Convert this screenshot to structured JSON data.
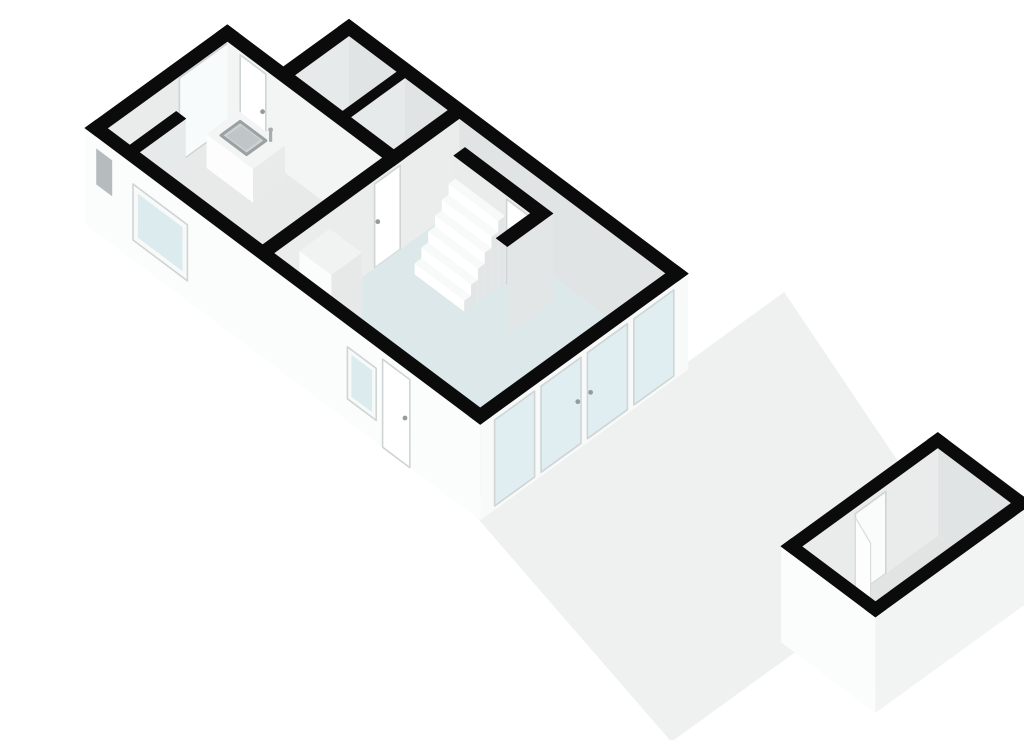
{
  "canvas": {
    "width": 1024,
    "height": 724,
    "background": "#ffffff"
  },
  "view": {
    "type": "3d-floorplan-render",
    "floor": "ground-floor-with-garden-shed"
  },
  "projection": {
    "ox": 45,
    "oy": 200,
    "a": [
      0.8,
      -0.58
    ],
    "b": [
      0.8,
      0.6
    ],
    "wallHeight": 88
  },
  "colors": {
    "bg": "#ffffff",
    "band": "#0b0b0c",
    "terrace": "#eff1f1",
    "kitchenFloor": "#e8eae9",
    "livingFloor": "#dce8ea",
    "annexFloor": "#d8dcdc",
    "nookFloor": "#c7cbcc",
    "shedFloor": "#e2e4e4",
    "faceOuterSW": "#fbfcfc",
    "faceOuterSE": "#f2f4f4",
    "faceInnerBright": "#f3f5f5",
    "faceInnerMid": "#e9eceb",
    "faceInnerDark": "#e0e4e4",
    "facePartition": "#eaedec",
    "faceDivider": "#e7eaea",
    "faceEnd": "#e3e6e6",
    "glassPane": "#dcebee",
    "glassBright": "#f7fbfb",
    "frameWhite": "#f8fafa",
    "frameEdge": "#cfd4d5",
    "doorWhite": "#ffffff",
    "handle": "#949b9e",
    "slitDark": "#b6bcbe",
    "islandTop": "#f3f4f4",
    "islandSW": "#fdfdfd",
    "islandSE": "#e9ebeb",
    "sinkBasin": "#cdd3d4",
    "sinkRim": "#9aa1a3",
    "sinkInner": "#c0c6c8",
    "faucet": "#a7adaf",
    "cabTop": "#f1f2f2",
    "cabSW": "#fbfcfc",
    "cabSE": "#e7e9e9",
    "treadTop": "#f8fafa",
    "treadSW": "#ffffff",
    "treadSE": "#e3e6e6",
    "burner": "#3f4446",
    "doorway": "#fafcfc",
    "leaf": "#fdfdfd",
    "leafEdge": "#d8dcdd"
  },
  "scene": [
    {
      "t": "poly",
      "name": "terrace-floor",
      "pts": [
        [
          -6,
          494
        ],
        [
          380,
          494
        ],
        [
          284,
          782
        ],
        [
          88,
          782
        ],
        [
          88,
          806
        ],
        [
          -73,
          806
        ]
      ],
      "fill": "terrace"
    },
    {
      "t": "face",
      "name": "nw-wall-inner-face",
      "plane": "b",
      "at": 14,
      "u": [
        14,
        178
      ],
      "h": [
        0,
        88
      ],
      "fill": "faceInnerMid"
    },
    {
      "t": "face",
      "name": "kitchen-window-inner",
      "plane": "b",
      "at": 14,
      "u": [
        104,
        170
      ],
      "h": [
        2,
        86
      ],
      "fill": "glassBright",
      "frame": "frameEdge"
    },
    {
      "t": "band",
      "name": "nw-wall-top",
      "a": [
        0,
        178
      ],
      "b": [
        0,
        14
      ]
    },
    {
      "t": "face",
      "name": "ne-wall-inner-face",
      "plane": "a",
      "at": 246,
      "u": [
        84,
        480
      ],
      "h": [
        0,
        88
      ],
      "fill": "faceInnerDark"
    },
    {
      "t": "band",
      "name": "ne-wall-top",
      "a": [
        246,
        260
      ],
      "b": [
        70,
        494
      ]
    },
    {
      "t": "face",
      "name": "annex-nw-wall-inner-face",
      "plane": "b",
      "at": 84,
      "u": [
        178,
        246
      ],
      "h": [
        0,
        88
      ],
      "fill": "faceDivider"
    },
    {
      "t": "band",
      "name": "annex-nw-wall-top",
      "a": [
        178,
        260
      ],
      "b": [
        70,
        84
      ]
    },
    {
      "t": "poly",
      "name": "closet-left-floor",
      "pts": [
        [
          178,
          84
        ],
        [
          246,
          84
        ],
        [
          246,
          144
        ],
        [
          178,
          144
        ]
      ],
      "fill": "annexFloor"
    },
    {
      "t": "poly",
      "name": "closet-right-floor",
      "pts": [
        [
          178,
          154
        ],
        [
          246,
          154
        ],
        [
          246,
          208
        ],
        [
          178,
          208
        ]
      ],
      "fill": "annexFloor"
    },
    {
      "t": "face",
      "name": "closet-divider-face",
      "plane": "b",
      "at": 154,
      "u": [
        178,
        246
      ],
      "h": [
        0,
        88
      ],
      "fill": "faceDivider"
    },
    {
      "t": "band",
      "name": "closet-divider-top",
      "a": [
        178,
        246
      ],
      "b": [
        144,
        154
      ]
    },
    {
      "t": "face",
      "name": "kitchen-ne-wall-face",
      "plane": "a",
      "at": 164,
      "u": [
        14,
        208
      ],
      "h": [
        0,
        88
      ],
      "fill": "faceInnerBright"
    },
    {
      "t": "face",
      "name": "kitchen-door",
      "plane": "a",
      "at": 164,
      "u": [
        30,
        62
      ],
      "h": [
        0,
        84
      ],
      "fill": "doorWhite",
      "frame": "frameEdge",
      "handle": [
        58,
        44
      ]
    },
    {
      "t": "band",
      "name": "kitchen-ne-wall-top",
      "a": [
        164,
        178
      ],
      "b": [
        0,
        222
      ]
    },
    {
      "t": "face",
      "name": "sw-wall-inner-kitchen",
      "plane": "a",
      "at": 14,
      "u": [
        14,
        208
      ],
      "h": [
        0,
        88
      ],
      "fill": "kitchenFloor"
    },
    {
      "t": "face",
      "name": "sw-wall-inner-living",
      "plane": "a",
      "at": 14,
      "u": [
        222,
        480
      ],
      "h": [
        0,
        88
      ],
      "fill": "livingFloor"
    },
    {
      "t": "face",
      "name": "partition-nw-fill",
      "plane": "b",
      "at": 208,
      "u": [
        14,
        164
      ],
      "h": [
        0,
        88
      ],
      "fill": "kitchenFloor"
    },
    {
      "t": "poly",
      "name": "kitchen-floor",
      "pts": [
        [
          14,
          14
        ],
        [
          164,
          14
        ],
        [
          164,
          208
        ],
        [
          14,
          208
        ]
      ],
      "fill": "kitchenFloor"
    },
    {
      "t": "poly",
      "name": "meter-nook-floor",
      "pts": [
        [
          14,
          14
        ],
        [
          72,
          14
        ],
        [
          72,
          42
        ],
        [
          14,
          42
        ]
      ],
      "fill": "nookFloor"
    },
    {
      "t": "face",
      "name": "meter-nook-wall-face",
      "plane": "b",
      "at": 54,
      "u": [
        14,
        72
      ],
      "h": [
        0,
        88
      ],
      "fill": "faceDivider"
    },
    {
      "t": "band",
      "name": "meter-nook-wall-top",
      "a": [
        14,
        72
      ],
      "b": [
        42,
        54
      ]
    },
    {
      "t": "box",
      "name": "kitchen-island",
      "a": [
        118,
        158
      ],
      "b": [
        34,
        92
      ],
      "h": 34,
      "top": "islandTop",
      "sw": "islandSW",
      "se": "islandSE"
    },
    {
      "t": "topquad",
      "name": "island-sink-rim",
      "a": [
        126,
        150
      ],
      "b": [
        44,
        76
      ],
      "h": 34,
      "fill": "sinkBasin",
      "stroke": "sinkRim",
      "swd": 3
    },
    {
      "t": "topquad",
      "name": "island-sink-basin",
      "a": [
        129,
        147
      ],
      "b": [
        48,
        72
      ],
      "h": 34,
      "fill": "sinkInner"
    },
    {
      "t": "quad3",
      "name": "sink-faucet-arm",
      "pts": [
        [
          151,
          79,
          34
        ],
        [
          153,
          81,
          34
        ],
        [
          153,
          81,
          46
        ],
        [
          151,
          79,
          46
        ]
      ],
      "fill": "faucet"
    },
    {
      "t": "dot",
      "name": "sink-faucet",
      "p": [
        152,
        80,
        46
      ],
      "r": 2.4,
      "fill": "faucet"
    },
    {
      "t": "face",
      "name": "partition-face",
      "plane": "b",
      "at": 222,
      "u": [
        14,
        246
      ],
      "h": [
        0,
        88
      ],
      "fill": "facePartition"
    },
    {
      "t": "face",
      "name": "partition-door",
      "plane": "b",
      "at": 222,
      "u": [
        140,
        172
      ],
      "h": [
        0,
        84
      ],
      "fill": "doorWhite",
      "frame": "frameEdge",
      "handle": [
        144,
        44
      ]
    },
    {
      "t": "band",
      "name": "partition-top",
      "a": [
        14,
        246
      ],
      "b": [
        208,
        222
      ]
    },
    {
      "t": "poly",
      "name": "living-room-floor",
      "pts": [
        [
          14,
          222
        ],
        [
          246,
          222
        ],
        [
          246,
          488
        ],
        [
          14,
          488
        ]
      ],
      "fill": "livingFloor"
    },
    {
      "t": "face",
      "name": "glazed-wall-inner-fill",
      "plane": "b",
      "at": 480,
      "u": [
        14,
        246
      ],
      "h": [
        0,
        88
      ],
      "fill": "livingFloor"
    },
    {
      "t": "face",
      "name": "stair-wall-face",
      "plane": "a",
      "at": 211,
      "u": [
        250,
        360
      ],
      "h": [
        0,
        88
      ],
      "fill": "faceInnerMid"
    },
    {
      "t": "face",
      "name": "stair-wall-door",
      "plane": "a",
      "at": 211,
      "u": [
        316,
        344
      ],
      "h": [
        0,
        84
      ],
      "fill": "doorWhite",
      "frame": "frameEdge",
      "handle": [
        340,
        44
      ]
    },
    {
      "t": "face",
      "name": "stair-wall-end-face",
      "plane": "b",
      "at": 360,
      "u": [
        211,
        225
      ],
      "h": [
        0,
        88
      ],
      "fill": "faceEnd"
    },
    {
      "t": "band",
      "name": "stair-wall-top",
      "a": [
        211,
        225
      ],
      "b": [
        250,
        360
      ]
    },
    {
      "t": "face",
      "name": "stair-return-face",
      "plane": "b",
      "at": 360,
      "u": [
        168,
        211
      ],
      "h": [
        0,
        88
      ],
      "fill": "faceEnd"
    },
    {
      "t": "band",
      "name": "stair-return-top",
      "a": [
        168,
        211
      ],
      "b": [
        346,
        360
      ]
    },
    {
      "t": "box",
      "name": "stair-tread-6",
      "a": [
        202.5,
        211
      ],
      "b": [
        252,
        314
      ],
      "h": 66,
      "top": "treadTop",
      "sw": "treadSW",
      "se": "treadSE"
    },
    {
      "t": "box",
      "name": "stair-tread-5",
      "a": [
        194,
        202.5
      ],
      "b": [
        252,
        314
      ],
      "h": 55,
      "top": "treadTop",
      "sw": "treadSW",
      "se": "treadSE"
    },
    {
      "t": "box",
      "name": "stair-tread-4",
      "a": [
        185.5,
        194
      ],
      "b": [
        252,
        314
      ],
      "h": 44,
      "top": "treadTop",
      "sw": "treadSW",
      "se": "treadSE"
    },
    {
      "t": "box",
      "name": "stair-tread-3",
      "a": [
        177,
        185.5
      ],
      "b": [
        252,
        314
      ],
      "h": 33,
      "top": "treadTop",
      "sw": "treadSW",
      "se": "treadSE"
    },
    {
      "t": "box",
      "name": "stair-tread-2",
      "a": [
        168.5,
        177
      ],
      "b": [
        252,
        314
      ],
      "h": 22,
      "top": "treadTop",
      "sw": "treadSW",
      "se": "treadSE"
    },
    {
      "t": "box",
      "name": "stair-tread-1",
      "a": [
        160,
        168.5
      ],
      "b": [
        252,
        314
      ],
      "h": 11,
      "top": "treadTop",
      "sw": "treadSW",
      "se": "treadSE"
    },
    {
      "t": "box",
      "name": "tall-cabinet",
      "a": [
        44,
        82
      ],
      "b": [
        224,
        264
      ],
      "h": 74,
      "top": "cabTop",
      "sw": "cabSW",
      "se": "cabSE"
    },
    {
      "t": "box",
      "name": "cooktop-counter",
      "a": [
        14,
        44
      ],
      "b": [
        224,
        268
      ],
      "h": 32,
      "top": "cabTop",
      "sw": "cabSW",
      "se": "cabSE"
    },
    {
      "t": "dot",
      "name": "cooktop-burner-large",
      "p": [
        29,
        238,
        32
      ],
      "r": 6.5,
      "fill": "burner"
    },
    {
      "t": "dot",
      "name": "cooktop-burner-small",
      "p": [
        29,
        254,
        32
      ],
      "r": 5.5,
      "fill": "burner"
    },
    {
      "t": "face",
      "name": "glazed-wall-frame",
      "plane": "b",
      "at": 494,
      "u": [
        0,
        260
      ],
      "h": [
        -8,
        88
      ],
      "fill": "frameWhite"
    },
    {
      "t": "face",
      "name": "glass-panel-1",
      "plane": "b",
      "at": 494,
      "u": [
        18,
        68
      ],
      "h": [
        -4,
        82
      ],
      "fill": "glassPane",
      "op": 0.85,
      "frame": "frameEdge"
    },
    {
      "t": "face",
      "name": "glass-door-left",
      "plane": "b",
      "at": 494,
      "u": [
        76,
        126
      ],
      "h": [
        -4,
        82
      ],
      "fill": "glassPane",
      "op": 0.85,
      "frame": "frameEdge",
      "handle": [
        122,
        40
      ]
    },
    {
      "t": "face",
      "name": "glass-door-right",
      "plane": "b",
      "at": 494,
      "u": [
        134,
        184
      ],
      "h": [
        -4,
        82
      ],
      "fill": "glassPane",
      "op": 0.85,
      "frame": "frameEdge",
      "handle": [
        138,
        40
      ]
    },
    {
      "t": "face",
      "name": "glass-panel-4",
      "plane": "b",
      "at": 494,
      "u": [
        192,
        242
      ],
      "h": [
        -4,
        82
      ],
      "fill": "glassPane",
      "op": 0.85,
      "frame": "frameEdge"
    },
    {
      "t": "band",
      "name": "glazed-wall-top",
      "a": [
        0,
        260
      ],
      "b": [
        480,
        494
      ]
    },
    {
      "t": "face",
      "name": "sw-facade-face",
      "plane": "a",
      "at": 0,
      "u": [
        0,
        494
      ],
      "h": [
        -8,
        88
      ],
      "fill": "faceOuterSW"
    },
    {
      "t": "face",
      "name": "nook-slit-window",
      "plane": "a",
      "at": 0,
      "u": [
        14,
        34
      ],
      "h": [
        40,
        76
      ],
      "fill": "slitDark"
    },
    {
      "t": "face",
      "name": "facade-kitchen-window-frame",
      "plane": "a",
      "at": 0,
      "u": [
        60,
        128
      ],
      "h": [
        12,
        68
      ],
      "fill": "frameWhite",
      "frame": "frameEdge"
    },
    {
      "t": "face",
      "name": "facade-kitchen-window-glass",
      "plane": "a",
      "at": 0,
      "u": [
        66,
        122
      ],
      "h": [
        18,
        62
      ],
      "fill": "glassPane"
    },
    {
      "t": "face",
      "name": "facade-living-window-frame",
      "plane": "a",
      "at": 0,
      "u": [
        328,
        364
      ],
      "h": [
        14,
        66
      ],
      "fill": "frameWhite",
      "frame": "frameEdge"
    },
    {
      "t": "face",
      "name": "facade-living-window-glass",
      "plane": "a",
      "at": 0,
      "u": [
        333,
        359
      ],
      "h": [
        19,
        61
      ],
      "fill": "glassPane"
    },
    {
      "t": "face",
      "name": "front-door",
      "plane": "a",
      "at": 0,
      "u": [
        372,
        406
      ],
      "h": [
        -8,
        80
      ],
      "fill": "doorWhite",
      "frame": "frameEdge",
      "handle": [
        400,
        38
      ]
    },
    {
      "t": "band",
      "name": "sw-wall-top",
      "a": [
        0,
        14
      ],
      "b": [
        0,
        494
      ]
    },
    {
      "t": "face",
      "name": "shed-ne-wall-inner",
      "plane": "a",
      "at": 271,
      "u": [
        795,
        887
      ],
      "h": [
        0,
        88
      ],
      "fill": "faceInnerDark"
    },
    {
      "t": "band",
      "name": "shed-ne-wall-top",
      "a": [
        271,
        284
      ],
      "b": [
        782,
        900
      ]
    },
    {
      "t": "face",
      "name": "shed-nw-wall-inner",
      "plane": "b",
      "at": 795,
      "u": [
        101,
        271
      ],
      "h": [
        0,
        88
      ],
      "fill": "faceInnerMid"
    },
    {
      "t": "face",
      "name": "shed-doorway",
      "plane": "b",
      "at": 795,
      "u": [
        168,
        206
      ],
      "h": [
        0,
        82
      ],
      "fill": "doorway",
      "frame": "frameEdge"
    },
    {
      "t": "band",
      "name": "shed-nw-wall-top",
      "a": [
        88,
        284
      ],
      "b": [
        782,
        795
      ]
    },
    {
      "t": "poly",
      "name": "shed-floor",
      "pts": [
        [
          101,
          795
        ],
        [
          271,
          795
        ],
        [
          271,
          887
        ],
        [
          101,
          887
        ]
      ],
      "fill": "shedFloor"
    },
    {
      "t": "face",
      "name": "shed-se-wall-innerfill",
      "plane": "b",
      "at": 887,
      "u": [
        101,
        271
      ],
      "h": [
        0,
        88
      ],
      "fill": "shedFloor"
    },
    {
      "t": "face",
      "name": "shed-sw-wall-innerfill",
      "plane": "a",
      "at": 101,
      "u": [
        795,
        887
      ],
      "h": [
        0,
        88
      ],
      "fill": "shedFloor"
    },
    {
      "t": "quad3",
      "name": "shed-door-leaf",
      "pts": [
        [
          168,
          795,
          78
        ],
        [
          156,
          826,
          78
        ],
        [
          156,
          826,
          0
        ],
        [
          168,
          795,
          0
        ]
      ],
      "fill": "leaf",
      "stroke": "leafEdge"
    },
    {
      "t": "face",
      "name": "shed-se-wall-outer",
      "plane": "b",
      "at": 900,
      "u": [
        88,
        284
      ],
      "h": [
        -8,
        88
      ],
      "fill": "faceOuterSE"
    },
    {
      "t": "face",
      "name": "shed-sw-wall-outer",
      "plane": "a",
      "at": 88,
      "u": [
        782,
        900
      ],
      "h": [
        -8,
        88
      ],
      "fill": "faceOuterSW"
    },
    {
      "t": "band",
      "name": "shed-se-wall-top",
      "a": [
        88,
        284
      ],
      "b": [
        887,
        900
      ]
    },
    {
      "t": "band",
      "name": "shed-sw-wall-top",
      "a": [
        88,
        101
      ],
      "b": [
        782,
        900
      ]
    }
  ]
}
